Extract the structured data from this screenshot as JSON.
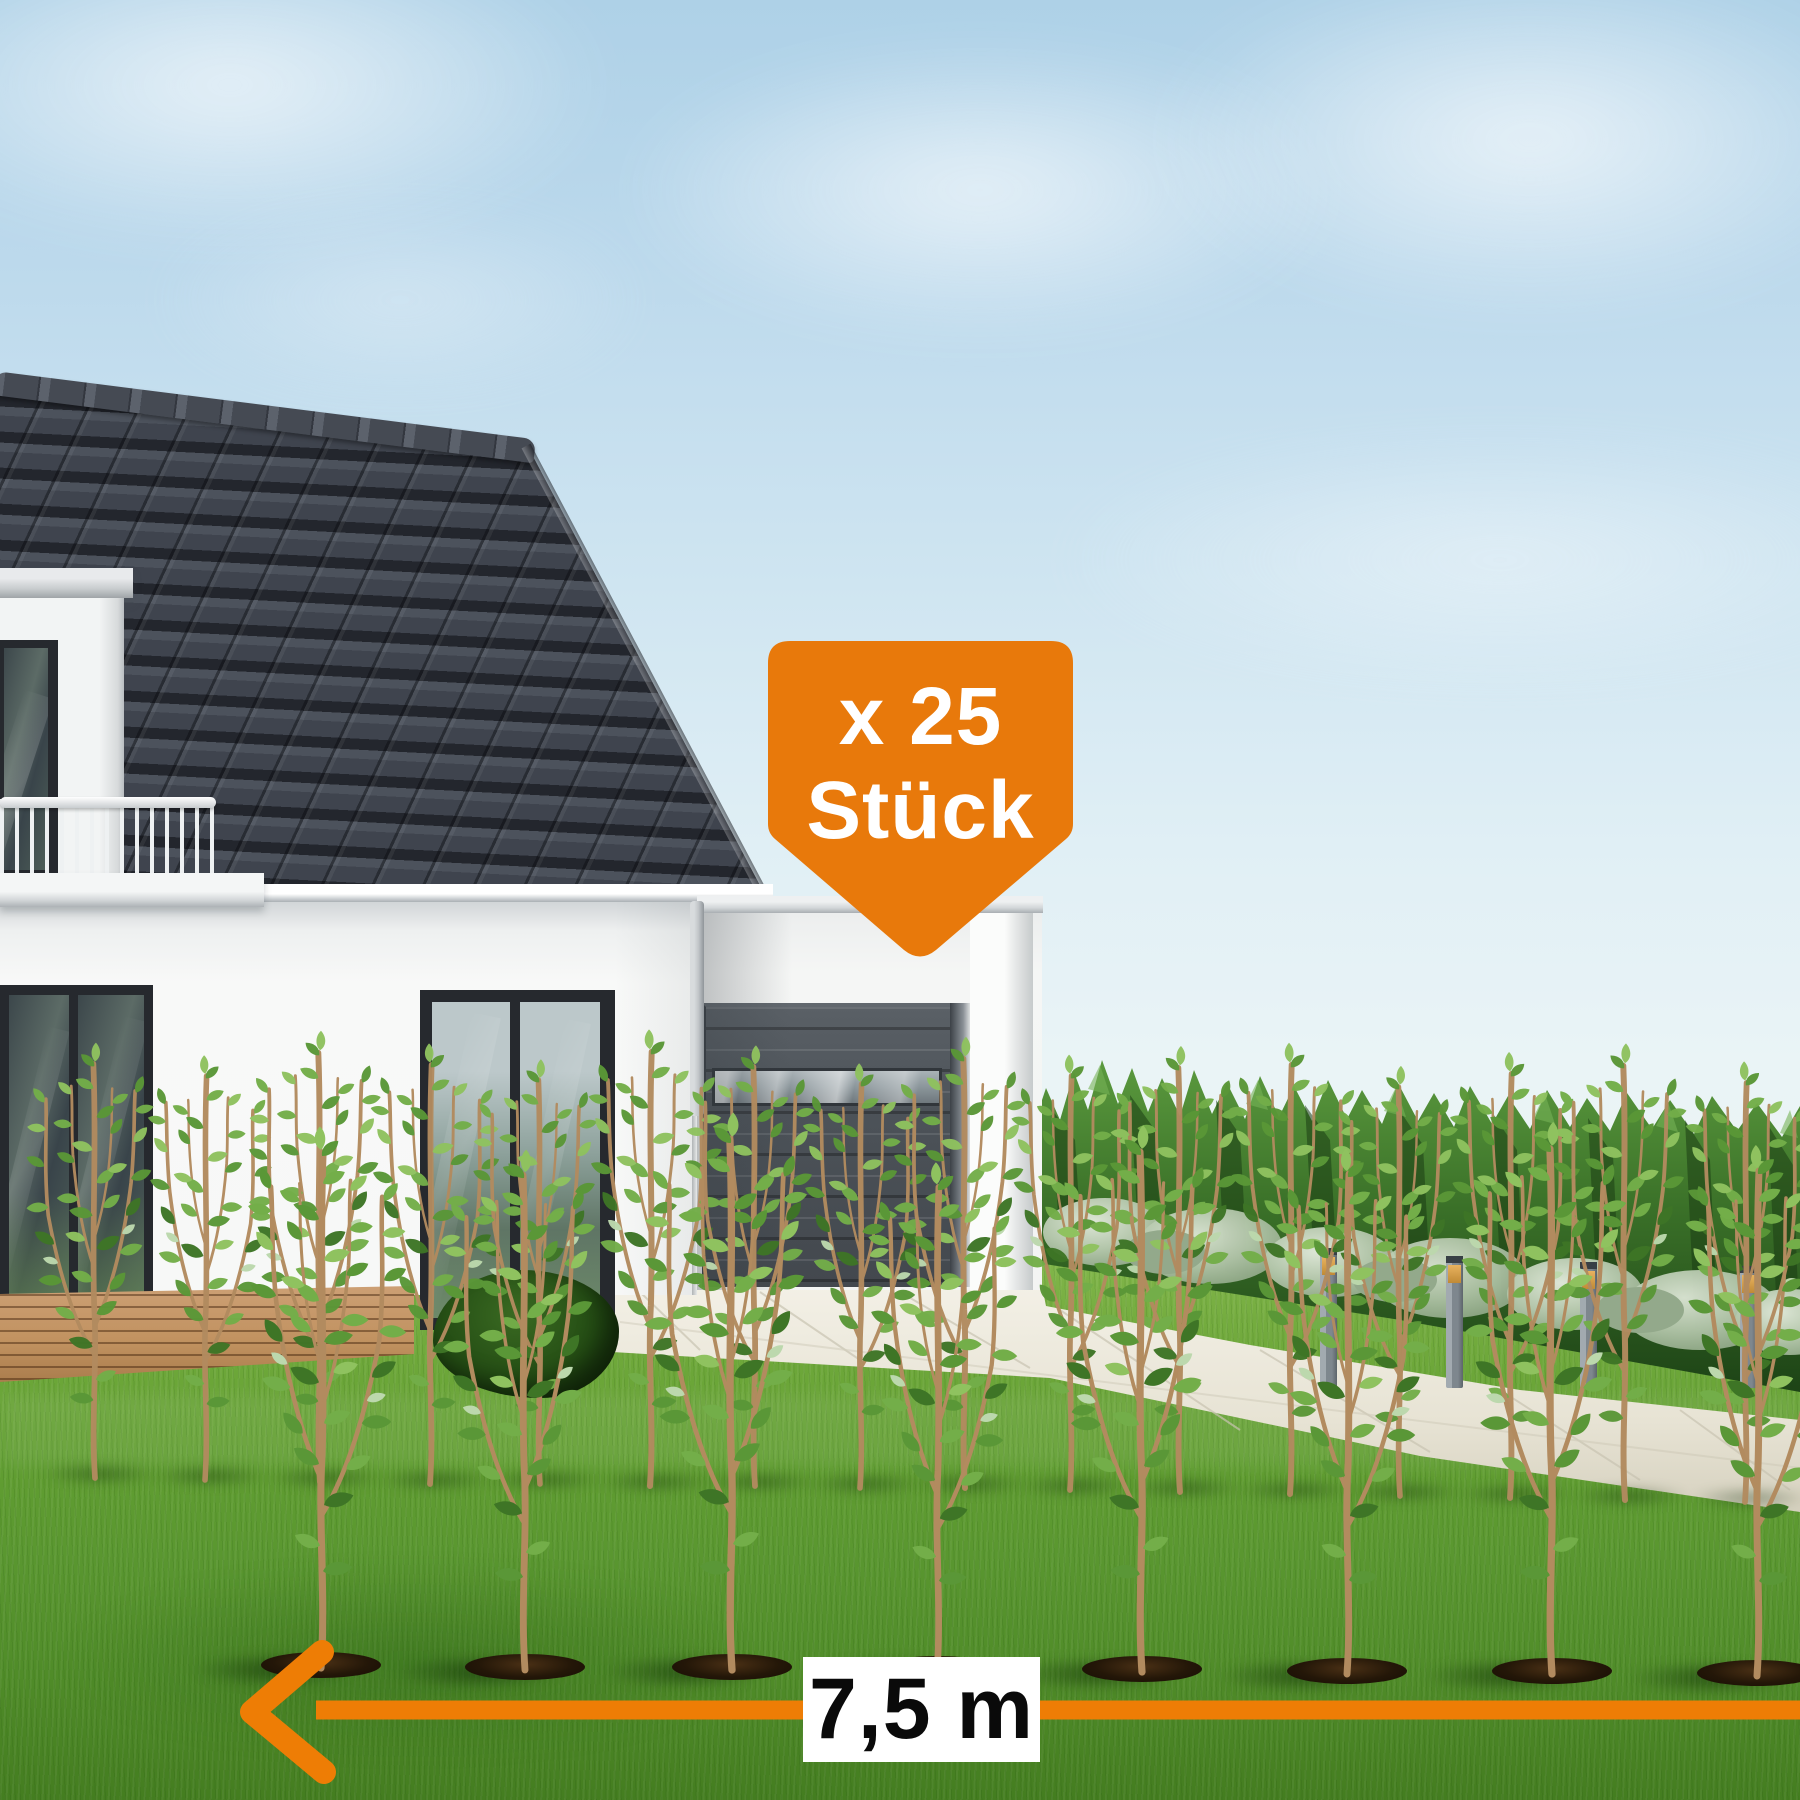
{
  "badge": {
    "line1": "x 25",
    "line2": "Stück",
    "background_color": "#E8790B",
    "text_color": "#FFFFFF"
  },
  "measurement": {
    "label": "7,5 m",
    "arrow_color": "#EE7D05",
    "label_background": "#FFFFFF",
    "label_text_color": "#0A0A0A"
  },
  "palette": {
    "sky_top": "#AED1E7",
    "sky_horizon": "#EDF5F2",
    "roof_tiles": "#454B55",
    "house_wall": "#F7F8F7",
    "garage_door": "#4C5258",
    "lawn": "#5F9C31",
    "background_hedge": "#2F5D22",
    "young_plant_leaf": "#5A9737",
    "plant_stem": "#B28B5F",
    "soil": "#241708",
    "deck_wood": "#C0915F",
    "pavement": "#E9E5D8"
  }
}
